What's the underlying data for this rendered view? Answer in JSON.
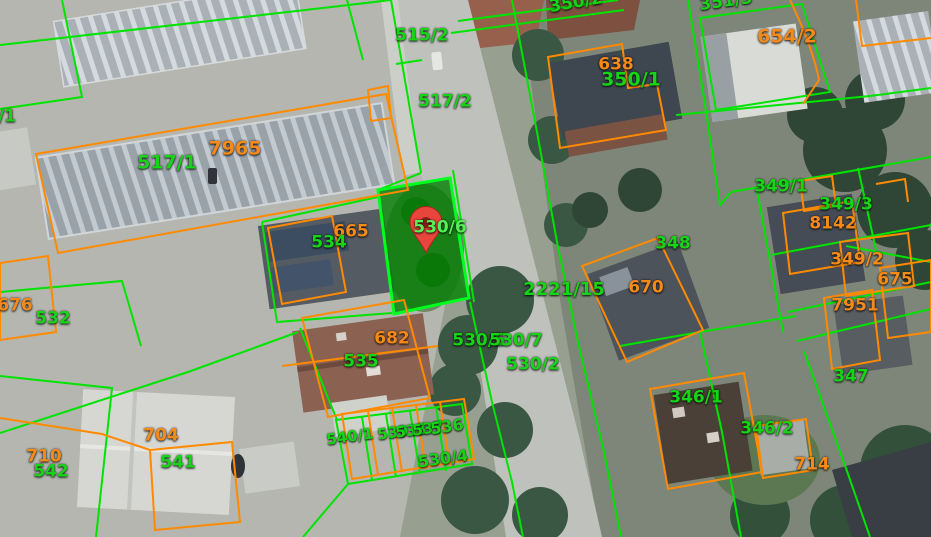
{
  "map": {
    "selected_parcel_label": "530/6",
    "marker": {
      "x": 426,
      "y": 253
    },
    "labels": [
      {
        "t": "515/2",
        "c": "green",
        "x": 422,
        "y": 36
      },
      {
        "t": "517/2",
        "c": "green",
        "x": 445,
        "y": 102
      },
      {
        "t": "350/2",
        "c": "green",
        "x": 576,
        "y": 3,
        "r": -10
      },
      {
        "t": "351/3",
        "c": "green",
        "x": 726,
        "y": 2,
        "r": -8
      },
      {
        "t": "654/2",
        "c": "orange",
        "x": 787,
        "y": 37,
        "s": 19
      },
      {
        "t": "638",
        "c": "orange",
        "x": 616,
        "y": 65
      },
      {
        "t": "350/1",
        "c": "green",
        "x": 631,
        "y": 80,
        "s": 19
      },
      {
        "t": "7965",
        "c": "orange",
        "x": 235,
        "y": 149,
        "s": 19
      },
      {
        "t": "517/1",
        "c": "green",
        "x": 167,
        "y": 163,
        "s": 19
      },
      {
        "t": "/1",
        "c": "green",
        "x": 7,
        "y": 117
      },
      {
        "t": "665",
        "c": "orange",
        "x": 351,
        "y": 232
      },
      {
        "t": "534",
        "c": "green",
        "x": 329,
        "y": 243
      },
      {
        "t": "530/6",
        "c": "bright",
        "x": 440,
        "y": 228
      },
      {
        "t": "2221/15",
        "c": "green",
        "x": 564,
        "y": 290,
        "s": 18
      },
      {
        "t": "530/5",
        "c": "green",
        "x": 479,
        "y": 341
      },
      {
        "t": "530/7",
        "c": "green",
        "x": 516,
        "y": 341
      },
      {
        "t": "530/2",
        "c": "green",
        "x": 533,
        "y": 365
      },
      {
        "t": "348",
        "c": "green",
        "x": 673,
        "y": 244
      },
      {
        "t": "670",
        "c": "orange",
        "x": 646,
        "y": 288
      },
      {
        "t": "349/1",
        "c": "green",
        "x": 781,
        "y": 187
      },
      {
        "t": "349/3",
        "c": "green",
        "x": 846,
        "y": 205
      },
      {
        "t": "8142",
        "c": "orange",
        "x": 833,
        "y": 224
      },
      {
        "t": "349/2",
        "c": "orange",
        "x": 857,
        "y": 260
      },
      {
        "t": "675",
        "c": "orange",
        "x": 895,
        "y": 280
      },
      {
        "t": "7951",
        "c": "orange",
        "x": 855,
        "y": 306
      },
      {
        "t": "347",
        "c": "green",
        "x": 851,
        "y": 377
      },
      {
        "t": "676",
        "c": "orange",
        "x": 15,
        "y": 306
      },
      {
        "t": "532",
        "c": "green",
        "x": 53,
        "y": 319
      },
      {
        "t": "682",
        "c": "orange",
        "x": 392,
        "y": 339
      },
      {
        "t": "535",
        "c": "green",
        "x": 361,
        "y": 362
      },
      {
        "t": "346/1",
        "c": "green",
        "x": 696,
        "y": 398
      },
      {
        "t": "346/2",
        "c": "green",
        "x": 767,
        "y": 429
      },
      {
        "t": "714",
        "c": "orange",
        "x": 812,
        "y": 465
      },
      {
        "t": "704",
        "c": "orange",
        "x": 161,
        "y": 436
      },
      {
        "t": "710",
        "c": "orange",
        "x": 44,
        "y": 457
      },
      {
        "t": "542",
        "c": "green",
        "x": 51,
        "y": 472
      },
      {
        "t": "541",
        "c": "green",
        "x": 178,
        "y": 463
      },
      {
        "t": "540/1",
        "c": "green",
        "x": 350,
        "y": 437,
        "r": -8,
        "s": 15
      },
      {
        "t": "539",
        "c": "green",
        "x": 393,
        "y": 433,
        "r": -8,
        "s": 15
      },
      {
        "t": "538",
        "c": "green",
        "x": 411,
        "y": 431,
        "r": -8,
        "s": 15
      },
      {
        "t": "537",
        "c": "green",
        "x": 428,
        "y": 429,
        "r": -8,
        "s": 15
      },
      {
        "t": "536",
        "c": "green",
        "x": 447,
        "y": 427,
        "r": -8,
        "s": 16
      },
      {
        "t": "530/4",
        "c": "green",
        "x": 443,
        "y": 459,
        "r": -8,
        "s": 16
      }
    ]
  },
  "colors": {
    "line_green": "#00e400",
    "line_orange": "#ff8a00",
    "label_green": "#17d417",
    "label_orange": "#f58a19",
    "label_bright_green": "#57ee57",
    "selected_fill": "rgba(0,126,0,0.78)",
    "selected_stroke": "#00ff1e",
    "marker": "#e8453c"
  }
}
